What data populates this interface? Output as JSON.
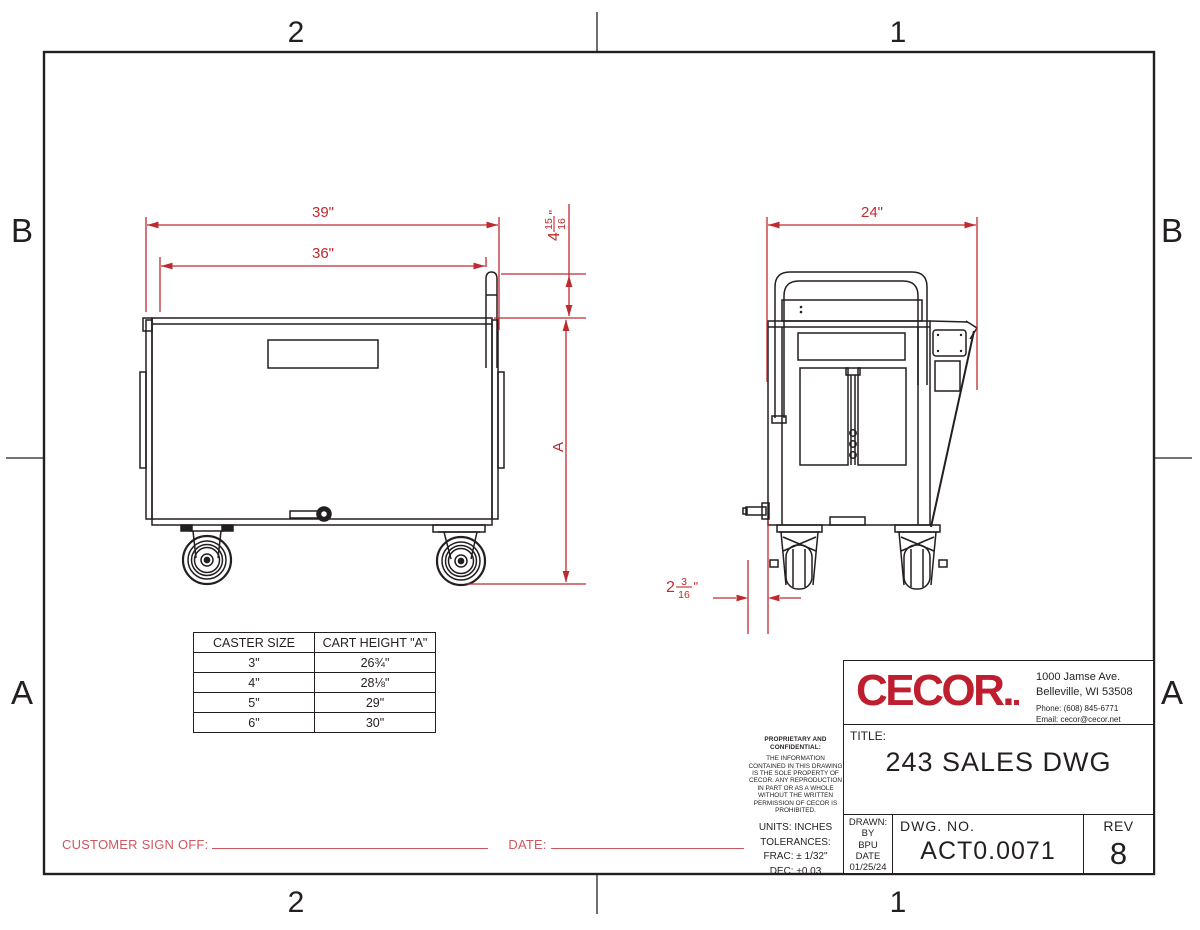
{
  "colors": {
    "line": "#231f20",
    "dim_red": "#bf2a30",
    "logo_red": "#be1e2d",
    "signoff_red": "#cf5660"
  },
  "zones": {
    "top": [
      "2",
      "1"
    ],
    "bottom": [
      "2",
      "1"
    ],
    "left": [
      "B",
      "A"
    ],
    "right": [
      "B",
      "A"
    ]
  },
  "dimensions": {
    "overall_width": "39\"",
    "inner_width": "36\"",
    "depth": "24\"",
    "cart_height": "A",
    "post_height": {
      "whole": "4",
      "num": "15",
      "den": "16",
      "unit": "\""
    },
    "pin_offset": {
      "whole": "2",
      "num": "3",
      "den": "16",
      "unit": "\""
    }
  },
  "caster_table": {
    "headers": [
      "CASTER SIZE",
      "CART HEIGHT \"A\""
    ],
    "rows": [
      [
        "3\"",
        "26¾\""
      ],
      [
        "4\"",
        "28⅛\""
      ],
      [
        "5\"",
        "29\""
      ],
      [
        "6\"",
        "30\""
      ]
    ]
  },
  "signoff": {
    "label": "CUSTOMER SIGN OFF:",
    "date_label": "DATE:"
  },
  "proprietary": {
    "heading": "PROPRIETARY AND CONFIDENTIAL:",
    "body": "THE INFORMATION CONTAINED IN THIS DRAWING IS THE SOLE PROPERTY OF CECOR. ANY REPRODUCTION IN PART OR AS A WHOLE WITHOUT THE WRITTEN PERMISSION OF CECOR IS PROHIBITED.",
    "units": "UNITS: INCHES",
    "tolerances": "TOLERANCES:",
    "frac": "FRAC: ± 1/32\"",
    "dec": "DEC: ±0.03"
  },
  "title_block": {
    "brand": "CECOR",
    "brand_mark": ".",
    "address_line1": "1000 Jamse Ave.",
    "address_line2": "Belleville, WI  53508",
    "phone": "Phone: (608) 845-6771",
    "email": "Email: cecor@cecor.net",
    "title_label": "TITLE:",
    "title": "243 SALES DWG",
    "drawn_label": "DRAWN:",
    "by_label": "BY",
    "drawn_by": "BPU",
    "date_label": "DATE",
    "date": "01/25/24",
    "dwg_label": "DWG.  NO.",
    "dwg_no": "ACT0.0071",
    "rev_label": "REV",
    "rev": "8"
  }
}
